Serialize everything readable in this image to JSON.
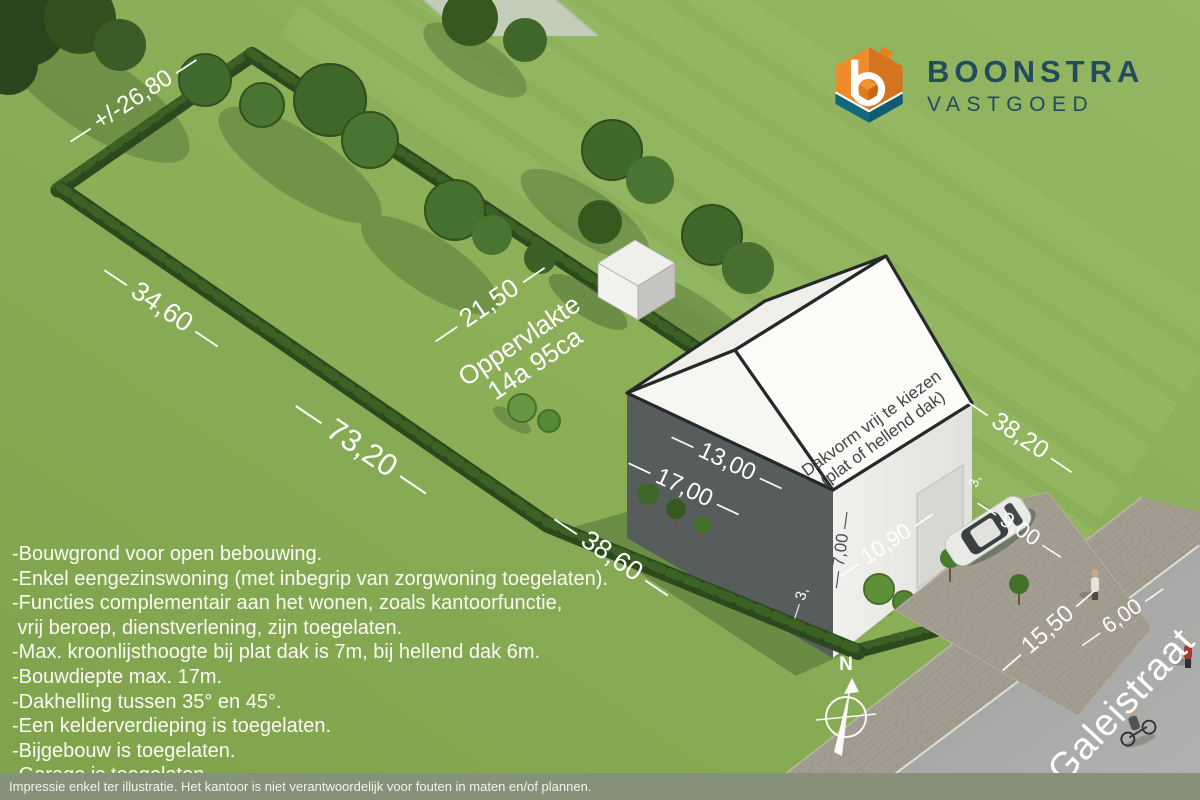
{
  "logo": {
    "brand": "BOONSTRA",
    "subtitle": "VASTGOED"
  },
  "dimensions": {
    "rear_width": "— +/-26,80 —",
    "side_left_a": "— 34,60 —",
    "side_left_b": "— 73,20 —",
    "inner_width": "— 21,50 —",
    "front_left": "— 38,60 —",
    "side_right": "— 38,20 —",
    "house_width": "— 13,00 —",
    "house_depth": "— 17,00 —",
    "house_height": "— 7,00 —",
    "front_yard_depth": "— 10,90 —",
    "front_yard_width": "— 9,00 —",
    "road_left": "— 15,50 —",
    "road_width": "— 6,00 —",
    "setback_left": "— 3,",
    "setback_right": "3,"
  },
  "area": {
    "line1": "Oppervlakte",
    "line2": "14a 95ca"
  },
  "roof_note": {
    "line1": "Dakvorm vrij te kiezen",
    "line2": "(plat of hellend dak)"
  },
  "street_name": "Galeistraat",
  "compass_label": "N",
  "regulations": [
    "-Bouwgrond voor open bebouwing.",
    "-Enkel eengezinswoning (met inbegrip van zorgwoning toegelaten).",
    "-Functies complementair aan het wonen, zoals kantoorfunctie,",
    " vrij beroep, dienstverlening, zijn toegelaten.",
    "-Max. kroonlijsthoogte bij plat dak is 7m, bij hellend dak 6m.",
    "-Bouwdiepte max. 17m.",
    "-Dakhelling tussen 35° en 45°.",
    "-Een kelderverdieping is toegelaten.",
    "-Bijgebouw is toegelaten.",
    "-Garage is toegelaten."
  ],
  "disclaimer": "Impressie enkel ter illustratie. Het kantoor is niet verantwoordelijk voor fouten in maten en/of plannen.",
  "colors": {
    "logo_orange": "#EE8C2B",
    "logo_orange_dark": "#D0701C",
    "logo_teal": "#14687E",
    "logo_text": "#214C5F",
    "grass": "#8AAB56",
    "hedge": "#2C481D",
    "house_wall_dark": "#54595A",
    "road": "#A8A8A6"
  }
}
